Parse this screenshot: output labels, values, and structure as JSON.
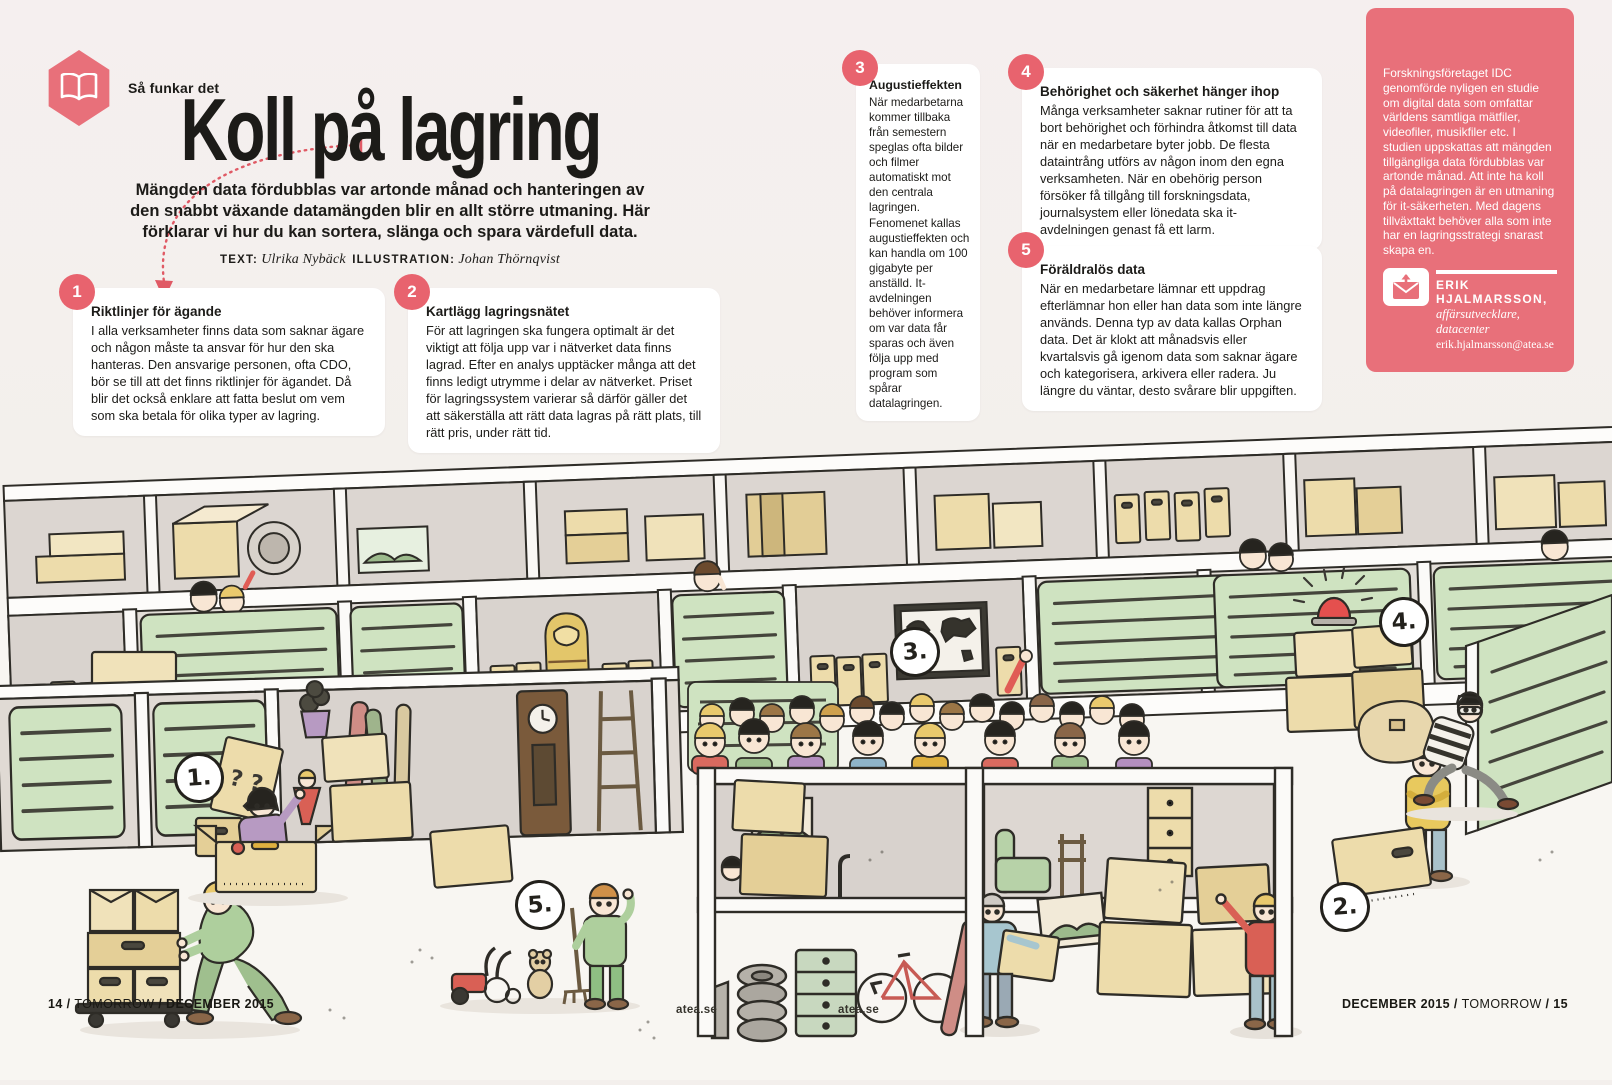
{
  "page": {
    "kicker": "Så funkar det",
    "title": "Koll på lagring",
    "standfirst": "Mängden data fördubblas var artonde månad och hanteringen av den snabbt växande datamängden blir en allt större utmaning. Här förklarar vi hur du kan sortera, slänga och spara värdefull data.",
    "byline_text_label": "TEXT:",
    "byline_text_name": "Ulrika Nybäck",
    "byline_illustration_label": "ILLUSTRATION:",
    "byline_illustration_name": "Johan Thörnqvist"
  },
  "tips": [
    {
      "number": "1",
      "title": "Riktlinjer för ägande",
      "body": "I alla verksamheter finns data som saknar ägare och någon måste ta ansvar för hur den ska hanteras. Den ansvarige personen, ofta CDO, bör se till att det finns riktlinjer för ägandet. Då blir det också enklare att fatta beslut om vem som ska betala för olika typer av lagring."
    },
    {
      "number": "2",
      "title": "Kartlägg lagringsnätet",
      "body": "För att lagringen ska fungera optimalt är det viktigt att följa upp var i nätverket data finns lagrad. Efter en analys upptäcker många att det finns ledigt utrymme i delar av nätverket. Priset för lagringssystem varierar så därför gäller det att säkerställa att rätt data lagras på rätt plats, till rätt pris, under rätt tid."
    },
    {
      "number": "3",
      "title": "Augustieffekten",
      "body": "När medarbetarna kommer tillbaka från semestern speglas ofta bilder och filmer automatiskt mot den centrala lagringen. Fenomenet kallas augustieffekten och kan handla om 100 gigabyte per anställd. It-avdelningen behöver informera om var data får sparas och även följa upp med program som spårar datalagringen."
    },
    {
      "number": "4",
      "title": "Behörighet och säkerhet hänger ihop",
      "body": "Många verksamheter saknar rutiner för att ta bort behörighet och förhindra åtkomst till data när en medarbetare byter jobb. De flesta dataintrång utförs av någon inom den egna verksamheten. När en obehörig person försöker få tillgång till forskningsdata, journalsystem eller lönedata ska it-avdelningen genast få ett larm."
    },
    {
      "number": "5",
      "title": "Föräldralös data",
      "body": "När en medarbetare lämnar ett uppdrag efterlämnar hon eller han data som inte längre används. Denna typ av data kallas Orphan data. Det är klokt att månadsvis eller kvartalsvis gå igenom data som saknar ägare och kategorisera, arkivera eller radera. Ju längre du väntar, desto svårare blir uppgiften."
    }
  ],
  "sidebar": {
    "body": "Forskningsföretaget IDC genomförde nyligen en studie om digital data som omfattar världens samtliga mätfiler, videofiler, musikfiler etc. I studien uppskattas att mängden tillgängliga data fördubblas var artonde månad. Att inte ha koll på datalagringen är en utmaning för it-säkerheten. Med dagens tillväxttakt behöver alla som inte har en lagringsstrategi snarast skapa en.",
    "contact_name": "ERIK HJALMARSSON,",
    "contact_role": "affärsutvecklare, datacenter",
    "contact_email": "erik.hjalmarsson@atea.se"
  },
  "illustration": {
    "markers": [
      "1.",
      "2.",
      "3.",
      "4.",
      "5."
    ],
    "mystery_box_label": "? ?",
    "floor_label_1": "atea.se",
    "floor_label_2": "atea.se"
  },
  "footer": {
    "left_page": "14",
    "left_sep1": "/",
    "left_magazine": "TOMORROW",
    "left_sep2": "/",
    "left_issue": "DECEMBER 2015",
    "right_issue": "DECEMBER 2015",
    "right_sep1": "/",
    "right_magazine": "TOMORROW",
    "right_sep2": "/",
    "right_page": "15"
  },
  "colors": {
    "accent_pink": "#e8707a",
    "badge_red": "#e8636e",
    "shutter_green": "#cfe3c1",
    "box_beige": "#eddcab",
    "ink": "#2e2c27",
    "paper": "#f3efec"
  }
}
